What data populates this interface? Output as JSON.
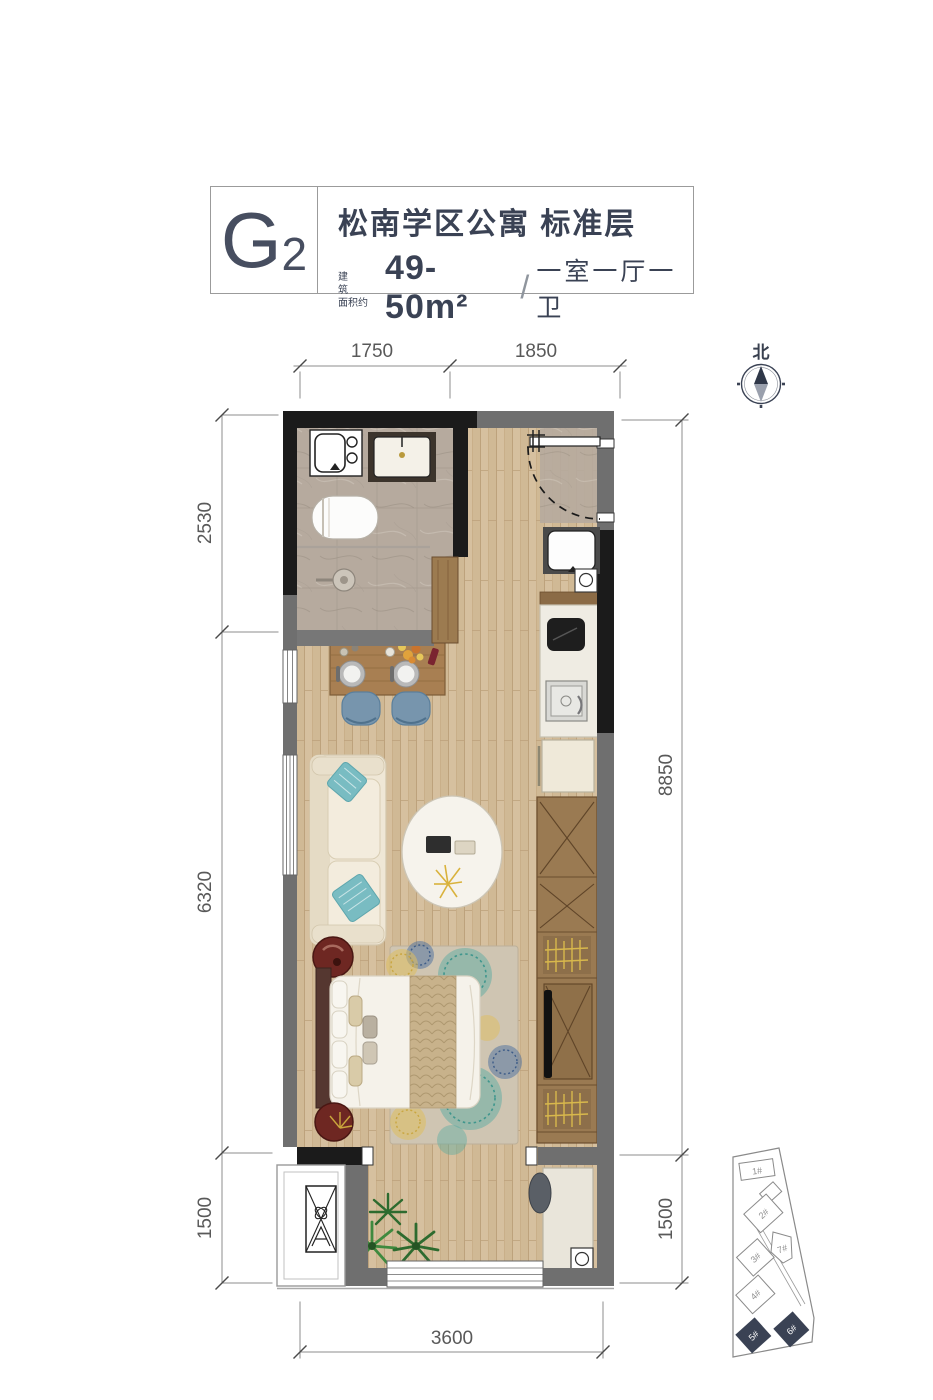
{
  "header": {
    "unit_code": "G",
    "unit_code_sub": "2",
    "title": "松南学区公寓 标准层",
    "area_label_line1": "建 筑",
    "area_label_line2": "面积约",
    "area_value": "49-50m²",
    "separator": "/",
    "layout_text": "一室一厅一卫"
  },
  "compass": {
    "north_label": "北"
  },
  "dimensions": {
    "top": [
      "1750",
      "1850"
    ],
    "left": [
      "2530",
      "6320",
      "1500"
    ],
    "right": [
      "8850",
      "1500"
    ],
    "bottom": [
      "3600"
    ]
  },
  "site_plan": {
    "buildings": [
      {
        "label": "1#",
        "highlighted": false
      },
      {
        "label": "2#",
        "highlighted": false
      },
      {
        "label": "3#",
        "highlighted": false
      },
      {
        "label": "4#",
        "highlighted": false
      },
      {
        "label": "5#",
        "highlighted": true
      },
      {
        "label": "6#",
        "highlighted": true
      },
      {
        "label": "7#",
        "highlighted": false
      }
    ]
  },
  "colors": {
    "accent_dark": "#3a4254",
    "wall_black": "#1b1b1b",
    "wall_gray": "#6f6f6f",
    "wood_floor": "#d5bf9e",
    "bath_marble": "#b6aa9e",
    "dim_text": "#595959"
  }
}
